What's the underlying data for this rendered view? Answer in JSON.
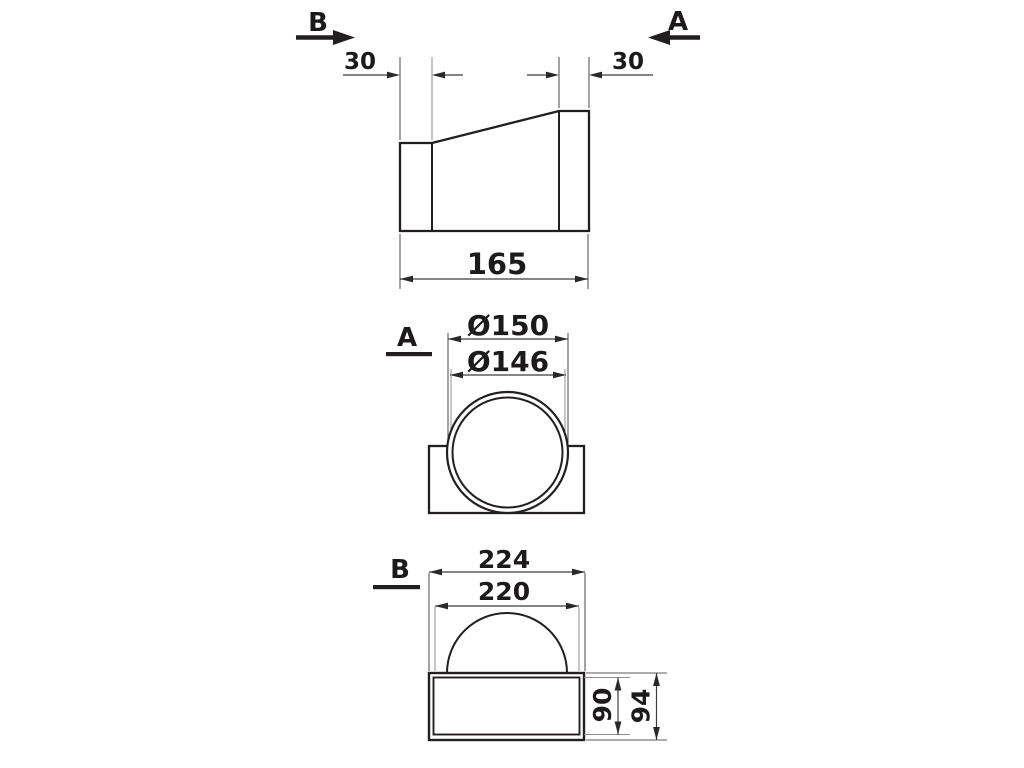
{
  "drawing": {
    "type": "technical-drawing",
    "description": "Dimensioned three-view drawing of a round-to-rectangular duct adapter",
    "colors": {
      "line": "#231f20",
      "dimension_line": "#3c3c3c",
      "extension_line": "#8d8d8d",
      "text": "#1d1a1b",
      "background": "#ffffff"
    }
  },
  "side_view": {
    "section_b_label": "B",
    "section_a_label": "A",
    "dim_collar_left": "30",
    "dim_collar_right": "30",
    "dim_length": "165"
  },
  "section_a": {
    "label": "A",
    "dim_outer_diameter": "Ø150",
    "dim_inner_diameter": "Ø146"
  },
  "section_b": {
    "label": "B",
    "dim_outer_width": "224",
    "dim_inner_width": "220",
    "dim_inner_height": "90",
    "dim_outer_height": "94"
  }
}
